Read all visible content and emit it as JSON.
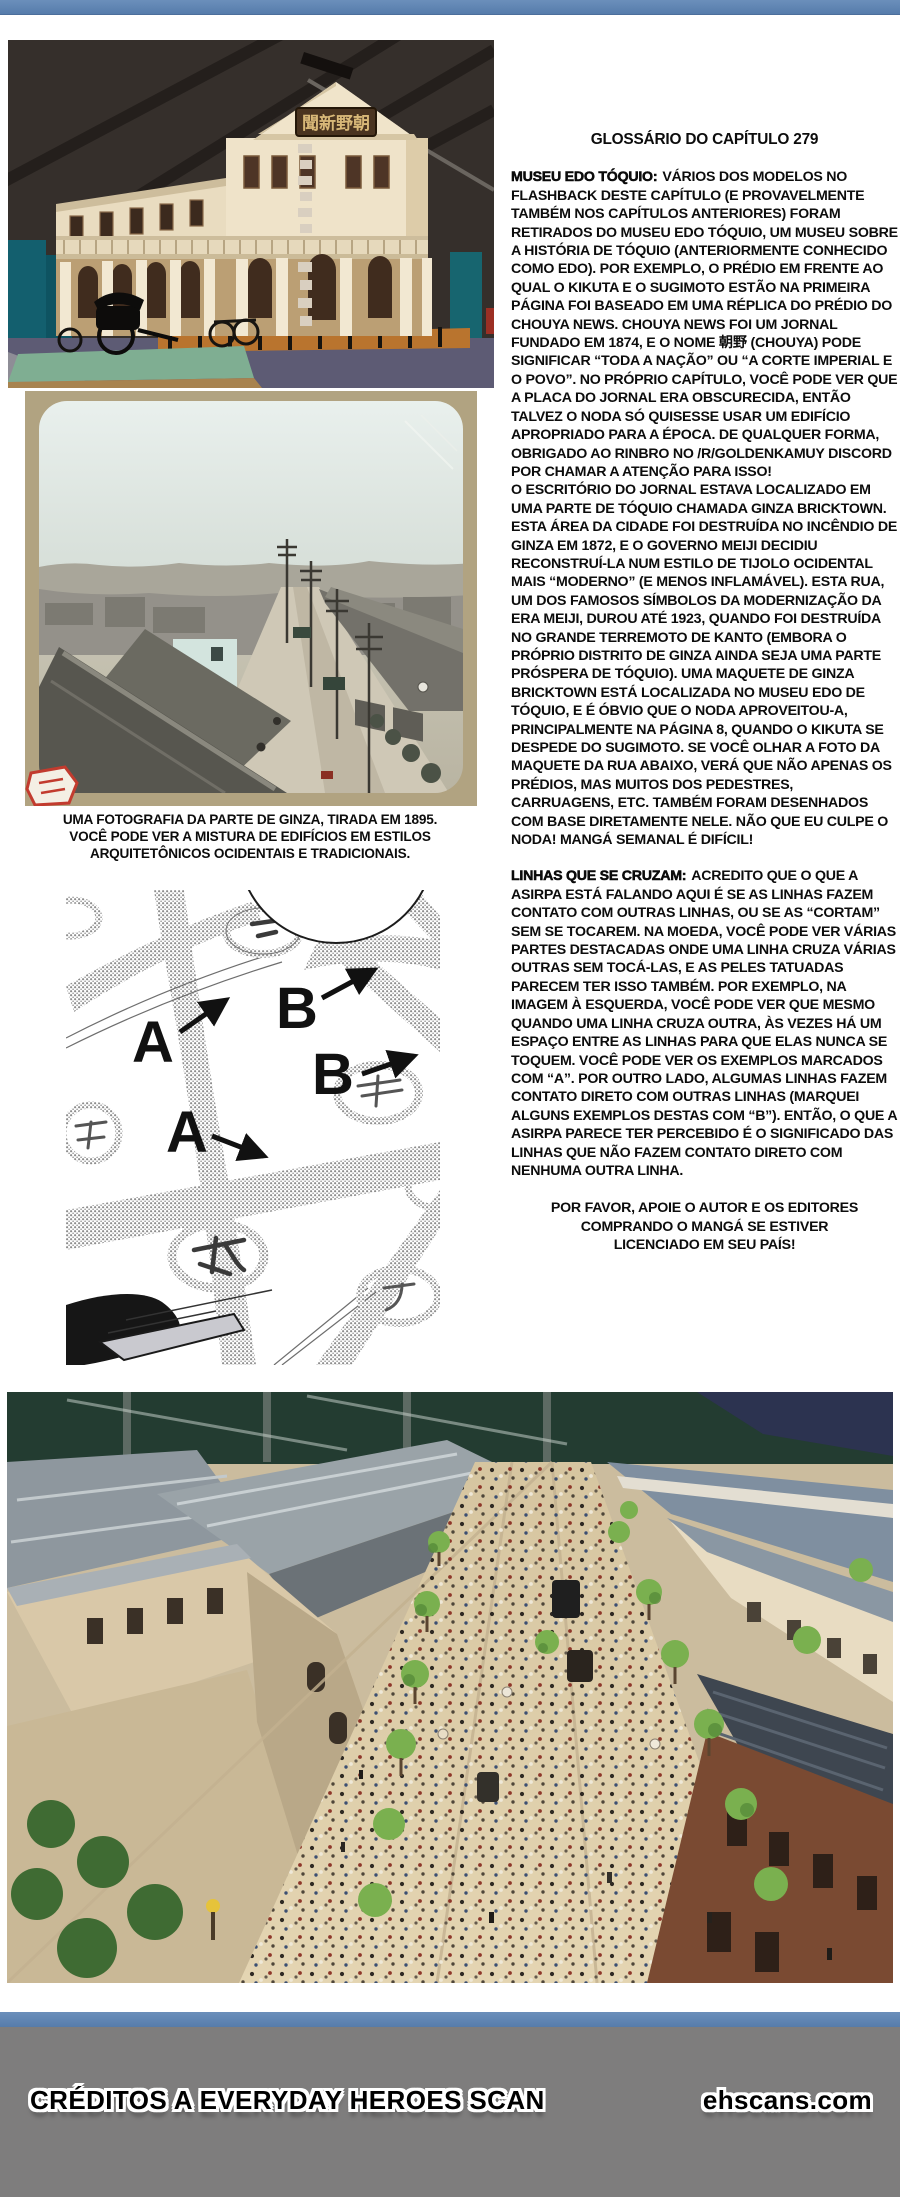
{
  "colors": {
    "top_bar_blue": "#5e84b2",
    "footer_gray": "#7e7d7d",
    "text_black": "#0c0c0c"
  },
  "photos": {
    "museum_model": {
      "sign_kanji": "聞新野朝"
    },
    "ginza_1895": {
      "caption": "UMA FOTOGRAFIA DA PARTE DE GINZA, TIRADA EM 1895. VOCÊ PODE VER A MISTURA DE EDIFÍCIOS EM ESTILOS ARQUITETÔNICOS OCIDENTAIS E TRADICIONAIS."
    }
  },
  "panel": {
    "labels": [
      "A",
      "B",
      "B",
      "A"
    ]
  },
  "glossary": {
    "title": "GLOSSÁRIO DO CAPÍTULO 279",
    "entries": [
      {
        "term": "MUSEU EDO TÓQUIO:",
        "text": "VÁRIOS DOS MODELOS NO FLASHBACK DESTE CAPÍTULO (E PROVAVELMENTE TAMBÉM NOS CAPÍTULOS ANTERIORES) FORAM RETIRADOS DO MUSEU EDO TÓQUIO, UM MUSEU SOBRE A HISTÓRIA DE TÓQUIO (ANTERIORMENTE CONHECIDO COMO EDO). POR EXEMPLO, O PRÉDIO EM FRENTE AO QUAL O KIKUTA E O SUGIMOTO ESTÃO NA PRIMEIRA PÁGINA FOI BASEADO EM UMA RÉPLICA DO PRÉDIO DO CHOUYA NEWS. CHOUYA NEWS FOI UM JORNAL FUNDADO EM 1874, E O NOME 朝野 (CHOUYA) PODE SIGNIFICAR “TODA A NAÇÃO” OU “A CORTE IMPERIAL E O POVO”. NO PRÓPRIO CAPÍTULO, VOCÊ PODE VER QUE A PLACA DO JORNAL ERA OBSCURECIDA, ENTÃO TALVEZ O NODA SÓ QUISESSE USAR UM EDIFÍCIO APROPRIADO PARA A ÉPOCA. DE QUALQUER FORMA, OBRIGADO AO RINBRO NO /R/GOLDENKAMUY DISCORD POR CHAMAR A ATENÇÃO PARA ISSO!",
        "text2": "O ESCRITÓRIO DO JORNAL ESTAVA LOCALIZADO EM UMA PARTE DE TÓQUIO CHAMADA GINZA BRICKTOWN. ESTA ÁREA DA CIDADE FOI DESTRUÍDA NO INCÊNDIO DE GINZA EM 1872, E O GOVERNO MEIJI DECIDIU RECONSTRUÍ-LA NUM ESTILO DE TIJOLO OCIDENTAL MAIS “MODERNO” (E MENOS INFLAMÁVEL). ESTA RUA, UM DOS FAMOSOS SÍMBOLOS DA MODERNIZAÇÃO DA ERA MEIJI, DUROU ATÉ 1923, QUANDO FOI DESTRUÍDA NO GRANDE TERREMOTO DE KANTO (EMBORA O PRÓPRIO DISTRITO DE GINZA AINDA SEJA UMA PARTE PRÓSPERA DE TÓQUIO). UMA MAQUETE DE GINZA BRICKTOWN ESTÁ LOCALIZADA NO MUSEU EDO DE TÓQUIO, E É ÓBVIO QUE O NODA APROVEITOU-A, PRINCIPALMENTE NA PÁGINA 8, QUANDO O KIKUTA SE DESPEDE DO SUGIMOTO. SE VOCÊ OLHAR A FOTO DA MAQUETE DA RUA ABAIXO, VERÁ QUE NÃO APENAS OS PRÉDIOS, MAS MUITOS DOS PEDESTRES, CARRUAGENS, ETC. TAMBÉM FORAM DESENHADOS COM BASE DIRETAMENTE NELE. NÃO QUE EU CULPE O NODA! MANGÁ SEMANAL É DIFÍCIL!"
      },
      {
        "term": "LINHAS QUE SE CRUZAM:",
        "text": "ACREDITO QUE O QUE A ASIRPA ESTÁ FALANDO AQUI É SE AS LINHAS FAZEM CONTATO COM OUTRAS LINHAS, OU SE AS “CORTAM” SEM SE TOCAREM. NA MOEDA, VOCÊ PODE VER VÁRIAS PARTES DESTACADAS ONDE UMA LINHA CRUZA VÁRIAS OUTRAS SEM TOCÁ-LAS, E AS PELES TATUADAS PARECEM TER ISSO TAMBÉM. POR EXEMPLO, NA IMAGEM À ESQUERDA, VOCÊ PODE VER QUE MESMO QUANDO UMA LINHA CRUZA OUTRA, ÀS VEZES HÁ UM ESPAÇO ENTRE AS LINHAS PARA QUE ELAS NUNCA SE TOQUEM. VOCÊ PODE VER OS EXEMPLOS MARCADOS COM “A”. POR OUTRO LADO, ALGUMAS LINHAS FAZEM CONTATO DIRETO COM OUTRAS LINHAS (MARQUEI ALGUNS EXEMPLOS DESTAS COM “B”). ENTÃO, O QUE A ASIRPA PARECE TER PERCEBIDO É O SIGNIFICADO DAS LINHAS QUE NÃO FAZEM CONTATO DIRETO COM NENHUMA OUTRA LINHA."
      }
    ],
    "support_note": "POR FAVOR, APOIE O AUTOR E OS EDITORES COMPRANDO O MANGÁ SE ESTIVER LICENCIADO EM SEU PAÍS!"
  },
  "footer": {
    "credits": "CRÉDITOS A EVERYDAY HEROES SCAN",
    "site": "ehscans.com"
  }
}
